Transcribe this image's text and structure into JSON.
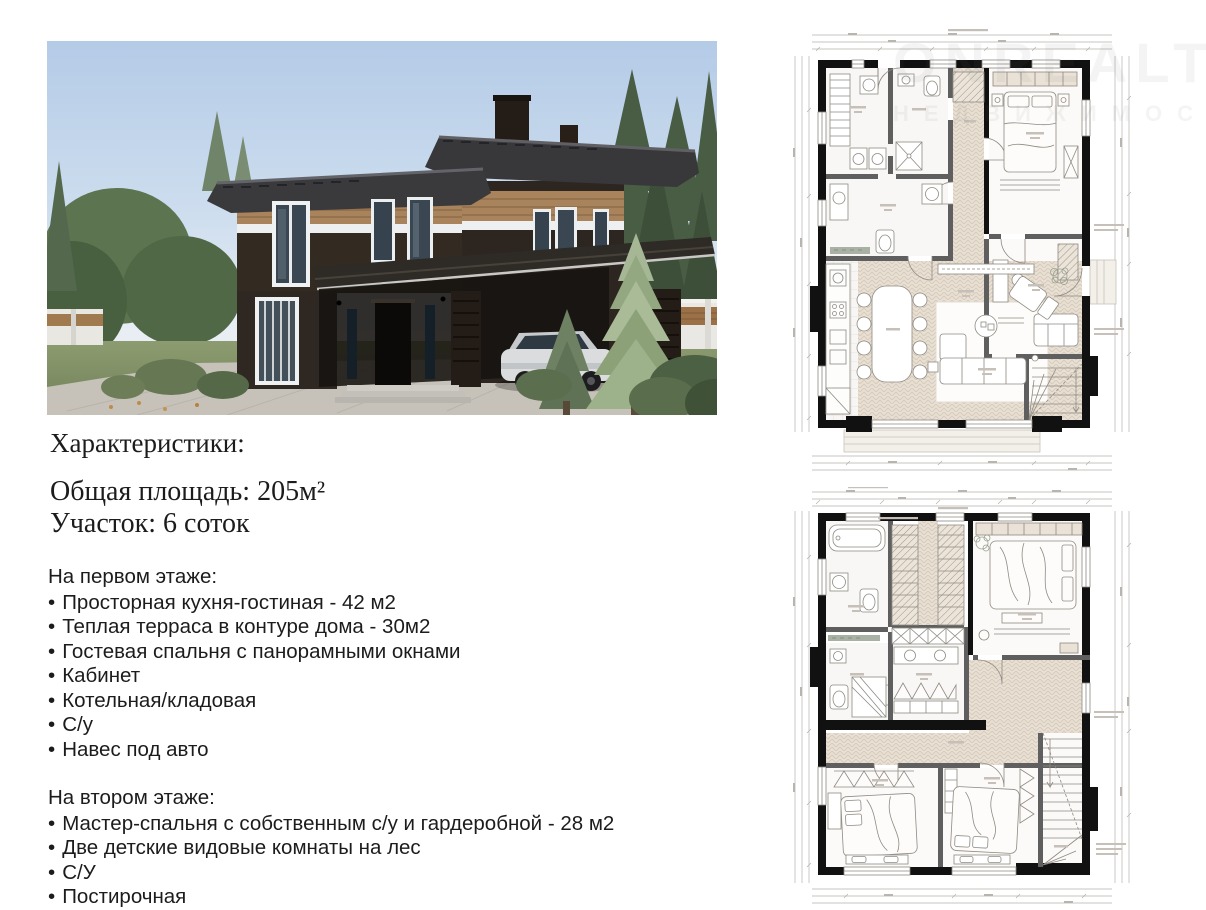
{
  "watermark": {
    "line1": "ONREALT",
    "line2": "НЕДВИЖИМОСТЬ"
  },
  "characteristics": {
    "title": "Характеристики:",
    "total_area": "Общая площадь: 205м²",
    "plot": "Участок: 6 соток"
  },
  "first_floor": {
    "heading": "На первом этаже:",
    "bullet": "•",
    "items": [
      "Просторная кухня-гостиная - 42 м2",
      "Теплая терраса в контуре дома - 30м2",
      "Гостевая спальня с панорамными окнами",
      "Кабинет",
      "Котельная/кладовая",
      "С/у",
      "Навес под авто"
    ]
  },
  "second_floor": {
    "heading": "На втором этаже:",
    "bullet": "•",
    "items": [
      "Мастер-спальня с собственным с/у и гардеробной - 28 м2",
      "Две детские видовые комнаты на лес",
      "С/У",
      "Постирочная"
    ]
  },
  "palette": {
    "wall_black": "#111111",
    "wall_gray": "#5f5f5f",
    "floor_beige": "#e9e1d4",
    "plan_line": "#8f8a83",
    "sky_blue": "#b9cfe8",
    "brick_dark": "#2f2720",
    "wood_band": "#a8835b",
    "white_band": "#edeff0",
    "grass_green": "#82915f",
    "driveway_gray": "#c6c2b9"
  }
}
